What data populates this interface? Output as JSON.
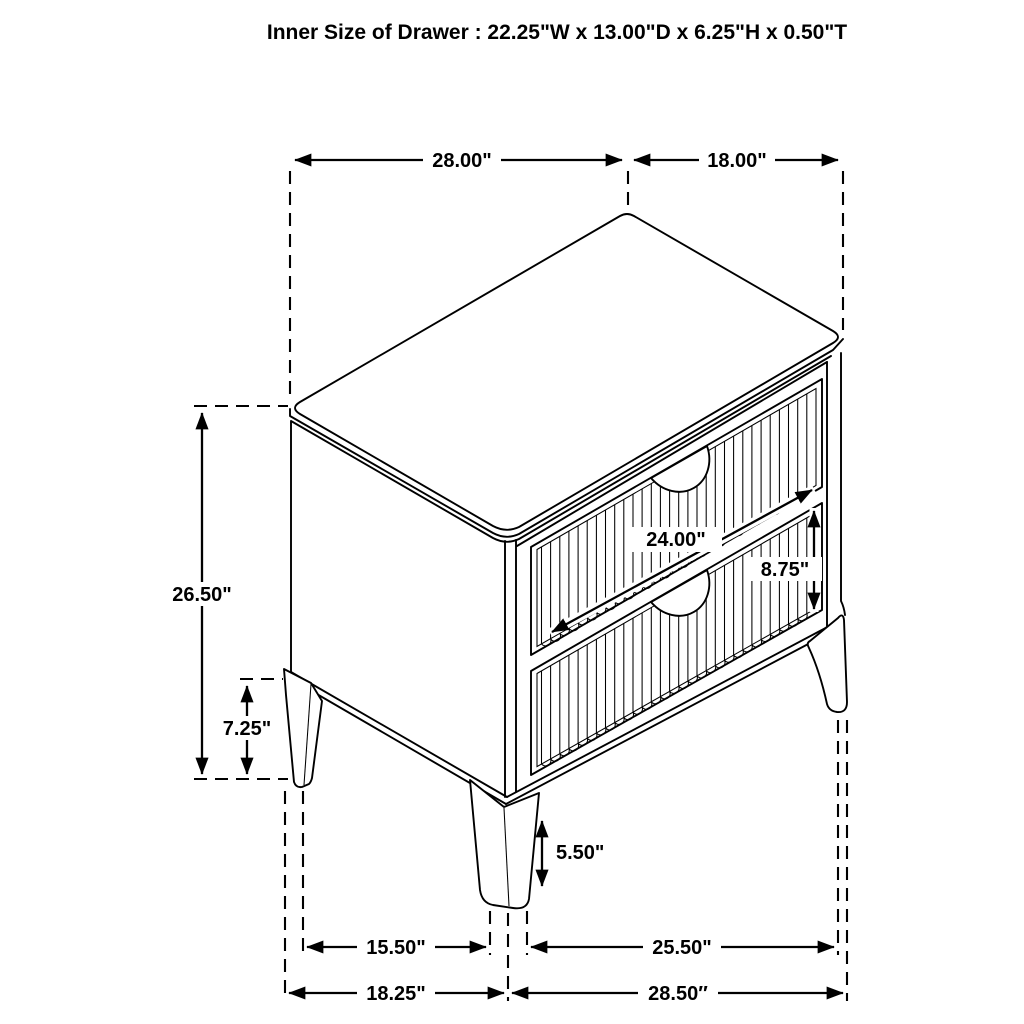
{
  "title": "Inner Size of Drawer : 22.25\"W x 13.00\"D x 6.25\"H x 0.50\"T",
  "colors": {
    "line": "#000000",
    "background": "#ffffff"
  },
  "dims": {
    "top_width": "28.00\"",
    "top_depth": "18.00\"",
    "overall_height": "26.50\"",
    "case_bottom_height": "7.25\"",
    "drawer_width": "24.00\"",
    "drawer_front_height": "8.75\"",
    "leg_height": "5.50\"",
    "leg_span_front": "15.50\"",
    "leg_span_side": "25.50\"",
    "base_width": "18.25\"",
    "base_depth": "28.50″"
  }
}
